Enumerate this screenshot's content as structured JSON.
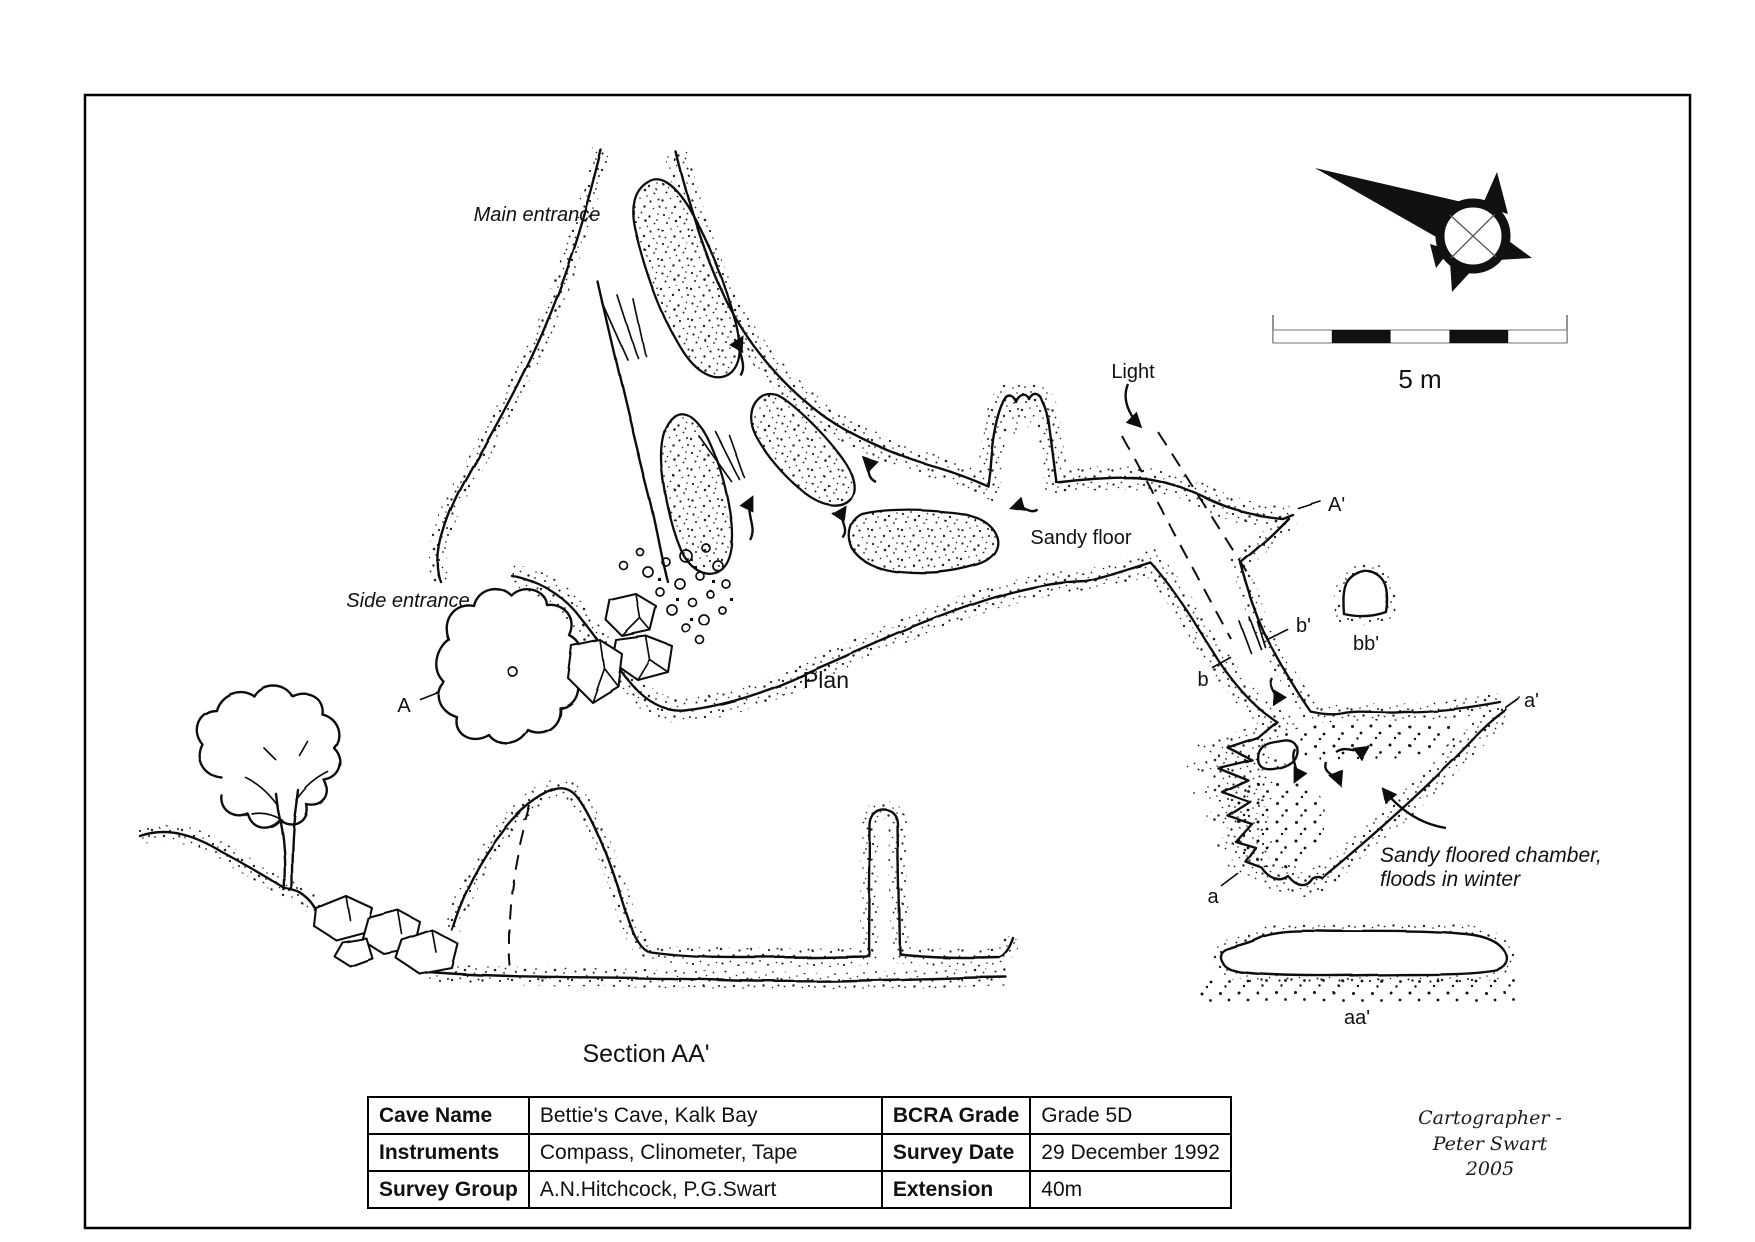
{
  "scale_bar": {
    "label": "5 m"
  },
  "plan": {
    "title": "Plan",
    "labels": {
      "main_entrance": "Main entrance",
      "side_entrance": "Side entrance",
      "light": "Light",
      "sandy_floor": "Sandy floor",
      "chamber_line1": "Sandy floored chamber,",
      "chamber_line2": "floods in winter"
    },
    "markers": {
      "A": "A",
      "A2": "A'",
      "a": "a",
      "a2": "a'",
      "b": "b",
      "b2": "b'",
      "bb2": "bb'"
    }
  },
  "section": {
    "title": "Section AA'",
    "aa_label": "aa'"
  },
  "info_table": {
    "rows": [
      {
        "k1": "Cave Name",
        "v1": "Bettie's Cave, Kalk Bay",
        "k2": "BCRA Grade",
        "v2": "Grade 5D"
      },
      {
        "k1": "Instruments",
        "v1": "Compass, Clinometer, Tape",
        "k2": "Survey Date",
        "v2": "29 December 1992"
      },
      {
        "k1": "Survey Group",
        "v1": "A.N.Hitchcock, P.G.Swart",
        "k2": "Extension",
        "v2": "40m"
      }
    ]
  },
  "credit": {
    "line1": "Cartographer - Peter Swart",
    "line2": "2005"
  },
  "colors": {
    "ink": "#111111",
    "paper": "#ffffff"
  }
}
